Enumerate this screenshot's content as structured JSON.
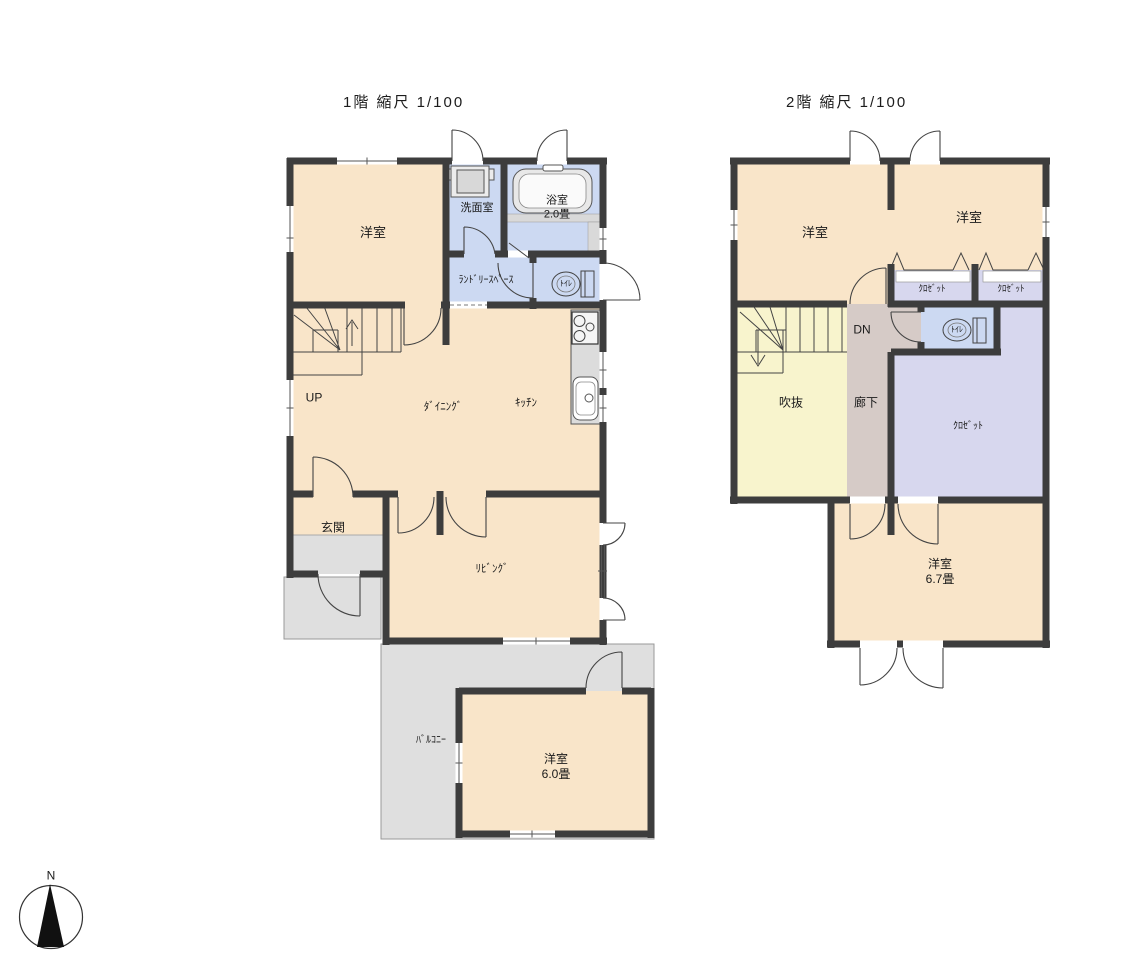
{
  "titles": {
    "floor1": "1階 縮尺 1/100",
    "floor2": "2階 縮尺 1/100"
  },
  "compass": {
    "north_label": "N"
  },
  "colors": {
    "background": "#ffffff",
    "wall": "#3d3d3d",
    "room_cream": "#f9e5c9",
    "wet_blue": "#ccd9f2",
    "closet_purple": "#d7d7ee",
    "void_yellow": "#f8f4cd",
    "corridor_tan": "#d6cbc7",
    "balcony_gray": "#dfdfdf",
    "fixture_gray": "#dcdcdc"
  },
  "floor1": {
    "rooms": {
      "youshitsu": "洋室",
      "senmenshitsu": "洗面室",
      "yokushitsu": "浴室",
      "yokushitsu_size": "2.0畳",
      "laundry": "ﾗﾝﾄﾞﾘｰｽﾍﾟｰｽ",
      "toilet": "ﾄｲﾚ",
      "stairs_up": "UP",
      "dining": "ﾀﾞｲﾆﾝｸﾞ",
      "kitchen": "ｷｯﾁﾝ",
      "genkan": "玄関",
      "living": "ﾘﾋﾞﾝｸﾞ",
      "balcony": "ﾊﾞﾙｺﾆｰ",
      "youshitsu2": "洋室",
      "youshitsu2_size": "6.0畳"
    }
  },
  "floor2": {
    "rooms": {
      "youshitsu_left": "洋室",
      "youshitsu_right": "洋室",
      "closet1": "ｸﾛｾﾞｯﾄ",
      "closet2": "ｸﾛｾﾞｯﾄ",
      "stairs_dn": "DN",
      "toilet": "ﾄｲﾚ",
      "fukinuke": "吹抜",
      "rouka": "廊下",
      "closet_big": "ｸﾛｾﾞｯﾄ",
      "youshitsu_b": "洋室",
      "youshitsu_b_size": "6.7畳"
    }
  }
}
